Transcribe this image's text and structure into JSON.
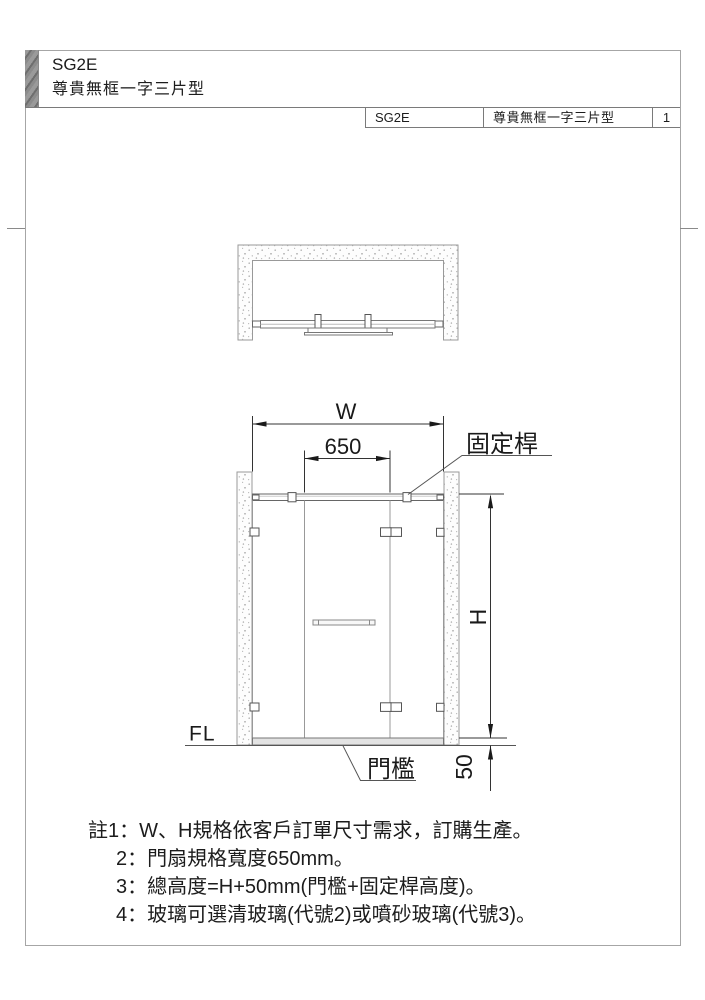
{
  "page": {
    "product_code": "SG2E",
    "product_name": "尊貴無框一字三片型",
    "title_block": {
      "model": "SG2E",
      "type_name": "尊貴無框一字三片型",
      "page_number": "1"
    }
  },
  "drawing": {
    "dimensions": {
      "width": "W",
      "door_width": "650",
      "height": "H",
      "threshold_height": "50"
    },
    "labels": {
      "fixed_bar": "固定桿",
      "floor_level": "FL",
      "threshold": "門檻"
    }
  },
  "notes": {
    "items": [
      "註1：W、H規格依客戶訂單尺寸需求，訂購生產。",
      "2：門扇規格寬度650mm。",
      "3：總高度=H+50mm(門檻+固定桿高度)。",
      "4：玻璃可選清玻璃(代號2)或噴砂玻璃(代號3)。"
    ]
  },
  "colors": {
    "dim_line": "#333333",
    "object_line": "#555555",
    "glass_line": "#999999",
    "tab_gray": "#8e8e8e",
    "threshold_fill": "#e3e3e3"
  }
}
